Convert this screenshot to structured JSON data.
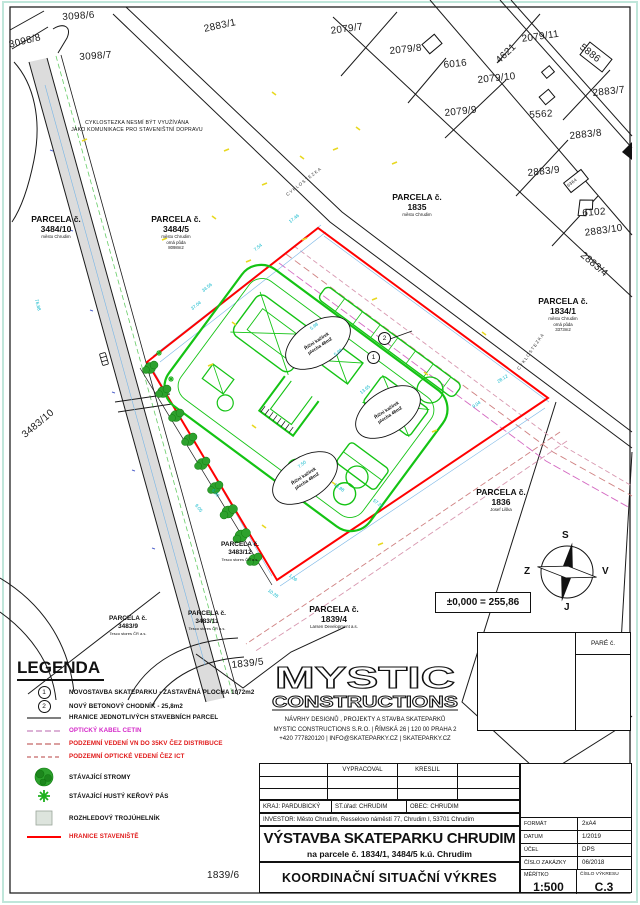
{
  "drawing": {
    "plot_labels": [
      {
        "text": "3098/6"
      },
      {
        "text": "3098/8"
      },
      {
        "text": "3098/7"
      },
      {
        "text": "2883/1"
      },
      {
        "text": "2079/7"
      },
      {
        "text": "2079/8"
      },
      {
        "text": "6016"
      },
      {
        "text": "4621"
      },
      {
        "text": "2079/11"
      },
      {
        "text": "2079/10"
      },
      {
        "text": "2079/9"
      },
      {
        "text": "5886"
      },
      {
        "text": "2883/7"
      },
      {
        "text": "5562"
      },
      {
        "text": "2883/8"
      },
      {
        "text": "2883/9"
      },
      {
        "text": "6364"
      },
      {
        "text": "6102"
      },
      {
        "text": "2883/10"
      },
      {
        "text": "2883/4"
      },
      {
        "text": "3483/10"
      },
      {
        "text": "1839/5"
      },
      {
        "text": "1839/6"
      }
    ],
    "parcels": [
      {
        "title": "PARCELA č.",
        "number": "3484/10",
        "sub": [
          "město Chrudim"
        ]
      },
      {
        "title": "PARCELA č.",
        "number": "3484/5",
        "sub": [
          "město Chrudim",
          "orná půda",
          "8098m2"
        ]
      },
      {
        "title": "PARCELA č.",
        "number": "1835",
        "sub": [
          "město Chrudim"
        ]
      },
      {
        "title": "PARCELA č.",
        "number": "1834/1",
        "sub": [
          "město Chrudim",
          "orná půda",
          "3373m2"
        ]
      },
      {
        "title": "PARCELA č.",
        "number": "1836",
        "sub": [
          "Josef Liška"
        ]
      },
      {
        "title": "PARCELA č.",
        "number": "3483/12",
        "sub": [
          "Tesco stores ČR a.s."
        ]
      },
      {
        "title": "PARCELA č.",
        "number": "3483/11",
        "sub": [
          "Tesco stores ČR a.s."
        ]
      },
      {
        "title": "PARCELA č.",
        "number": "3483/9",
        "sub": [
          "Tesco stores ČR a.s."
        ]
      },
      {
        "title": "PARCELA č.",
        "number": "1839/4",
        "sub": [
          "Larsen Development a.s."
        ]
      }
    ],
    "note_cyklostezka": [
      "CYKLOSTEZKA NESMÍ BÝT VYUŽÍVÁNA",
      "JAKO KOMUNIKACE PRO STAVENIŠTNÍ DOPRAVU"
    ],
    "path_label": "CYKLOSTEZKA",
    "callouts": {
      "one": "1",
      "two": "2"
    },
    "area_ellipse": {
      "line1": "Říční kačírek",
      "line2": "plocha 48m2"
    },
    "dims": [
      "37.04",
      "34.56",
      "7.54",
      "17.46",
      "5.98",
      "5.99",
      "13.65",
      "7.50",
      "13.88",
      "57.20",
      "9.04",
      "28.12",
      "10.28",
      "1.06",
      "6.20",
      "9.05",
      "76.88"
    ],
    "elevation": "±0,000 = 255,86",
    "compass": {
      "north": "S",
      "south": "J",
      "west": "Z",
      "east": "V"
    },
    "pare": "PARÉ č."
  },
  "legend": {
    "title": "LEGENDA",
    "items": [
      {
        "num": "1",
        "label": "NOVOSTAVBA SKATEPARKU - ZASTAVĚNÁ PLOCHA 1072m2"
      },
      {
        "num": "2",
        "label": "NOVÝ BETONOVÝ CHODNÍK - 25,8m2"
      },
      {
        "label": "HRANICE JEDNOTLIVÝCH STAVEBNÍCH PARCEL"
      },
      {
        "label": "OPTICKÝ KABEL CETIN"
      },
      {
        "label": "PODZEMNÍ VEDENÍ VN DO 35KV ČEZ DISTRIBUCE"
      },
      {
        "label": "PODZEMNÍ OPTICKÉ VEDENÍ ČEZ ICT"
      },
      {
        "label": "STÁVAJÍCÍ STROMY"
      },
      {
        "label": "STÁVAJÍCÍ HUSTÝ KEŘOVÝ PÁS"
      },
      {
        "label": "ROZHLEDOVÝ TROJÚHELNÍK"
      },
      {
        "label": "HRANICE STAVENIŠTĚ"
      }
    ]
  },
  "logo": {
    "name_top": "MYSTIC",
    "name_bottom": "CONSTRUCTIONS",
    "tagline": "NÁVRHY DESIGNŮ , PROJEKTY A STAVBA SKATEPARKŮ",
    "address": "MYSTIC CONSTRUCTIONS S.R.O.  |  ŘÍMSKÁ 26 | 120 00 PRAHA 2",
    "contact": "+420 777820120   |   INFO@SKATEPARKY.CZ   |   SKATEPARKY.CZ"
  },
  "titleblock": {
    "sig_col1": "VYPRACOVAL",
    "sig_col2": "KRESLIL",
    "kraj": "KRAJ: PARDUBICKÝ",
    "urad": "ST.úřad: CHRUDIM",
    "obec": "OBEC: CHRUDIM",
    "investor": "INVESTOR: Město Chrudim, Resselovo náměstí 77, Chrudim I, 53701 Chrudim",
    "title": "VÝSTAVBA SKATEPARKU CHRUDIM",
    "subtitle": "na parcele č. 1834/1, 3484/5  k.ú. Chrudim",
    "drawing_name": "KOORDINAČNÍ SITUAČNÍ VÝKRES",
    "rows": [
      {
        "label": "FORMÁT",
        "value": "2xA4"
      },
      {
        "label": "DATUM",
        "value": "1/2019"
      },
      {
        "label": "ÚČEL",
        "value": "DPS"
      },
      {
        "label": "ČÍSLO ZAKÁZKY",
        "value": "06/2018"
      }
    ],
    "meritko_label": "MĚŘÍTKO",
    "meritko": "1:500",
    "vykres_label": "ČÍSLO VÝKRESU",
    "vykres": "C.3"
  },
  "colors": {
    "site_boundary": "#ff0000",
    "skatepark": "#14c314",
    "cetin_cable": "#d428c8",
    "underground_lines": "#e01818",
    "dimensions": "#00b4c8",
    "trees": "#28a428"
  }
}
